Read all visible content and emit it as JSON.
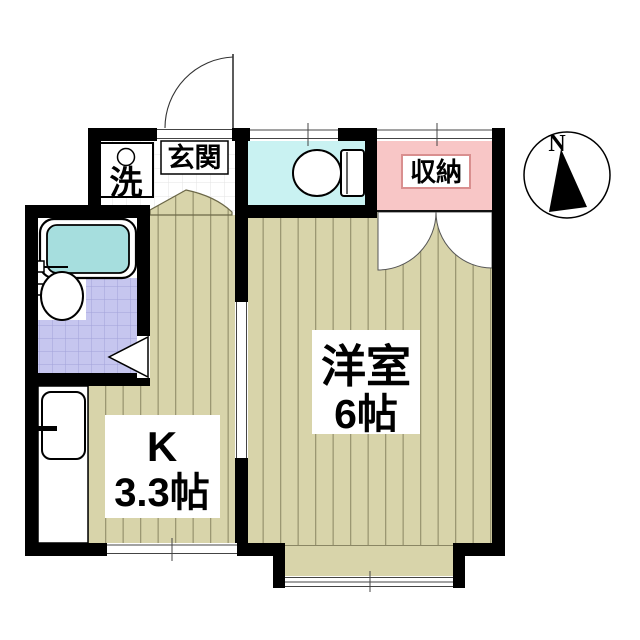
{
  "floorplan": {
    "type": "apartment-floor-plan",
    "rooms": {
      "genkan": {
        "label": "玄関"
      },
      "laundry": {
        "label": "洗"
      },
      "storage": {
        "label": "収納"
      },
      "kitchen": {
        "label_line1": "K",
        "label_line2": "3.3帖"
      },
      "western_room": {
        "label_line1": "洋室",
        "label_line2": "6帖"
      },
      "toilet": {
        "label": ""
      },
      "bathroom": {
        "label": ""
      }
    },
    "compass": {
      "label": "N"
    },
    "colors": {
      "wall": "#000000",
      "floor_beige": "#d8d4aa",
      "floor_stripe": "#9b9772",
      "toilet_cyan": "#c9f2f2",
      "storage_pink": "#f8c6c6",
      "bath_tile_purple": "#c6c6ef",
      "bath_tile_grid": "#a2a2da",
      "tub_cyan": "#a6dede",
      "tile_grid_gray": "#e3e3e3"
    }
  }
}
